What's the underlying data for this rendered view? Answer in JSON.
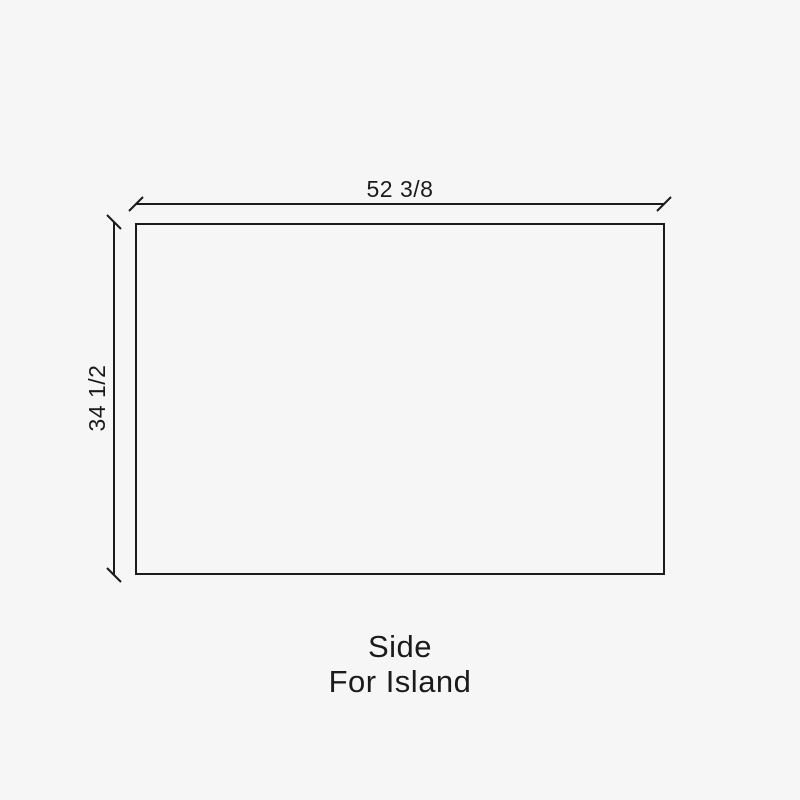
{
  "colors": {
    "background": "#f6f6f6",
    "ink": "#1b1b1b"
  },
  "drawing": {
    "width_dimension": {
      "label": "52 3/8"
    },
    "height_dimension": {
      "label": "34 1/2"
    },
    "caption": {
      "line1": "Side",
      "line2": "For Island"
    }
  }
}
